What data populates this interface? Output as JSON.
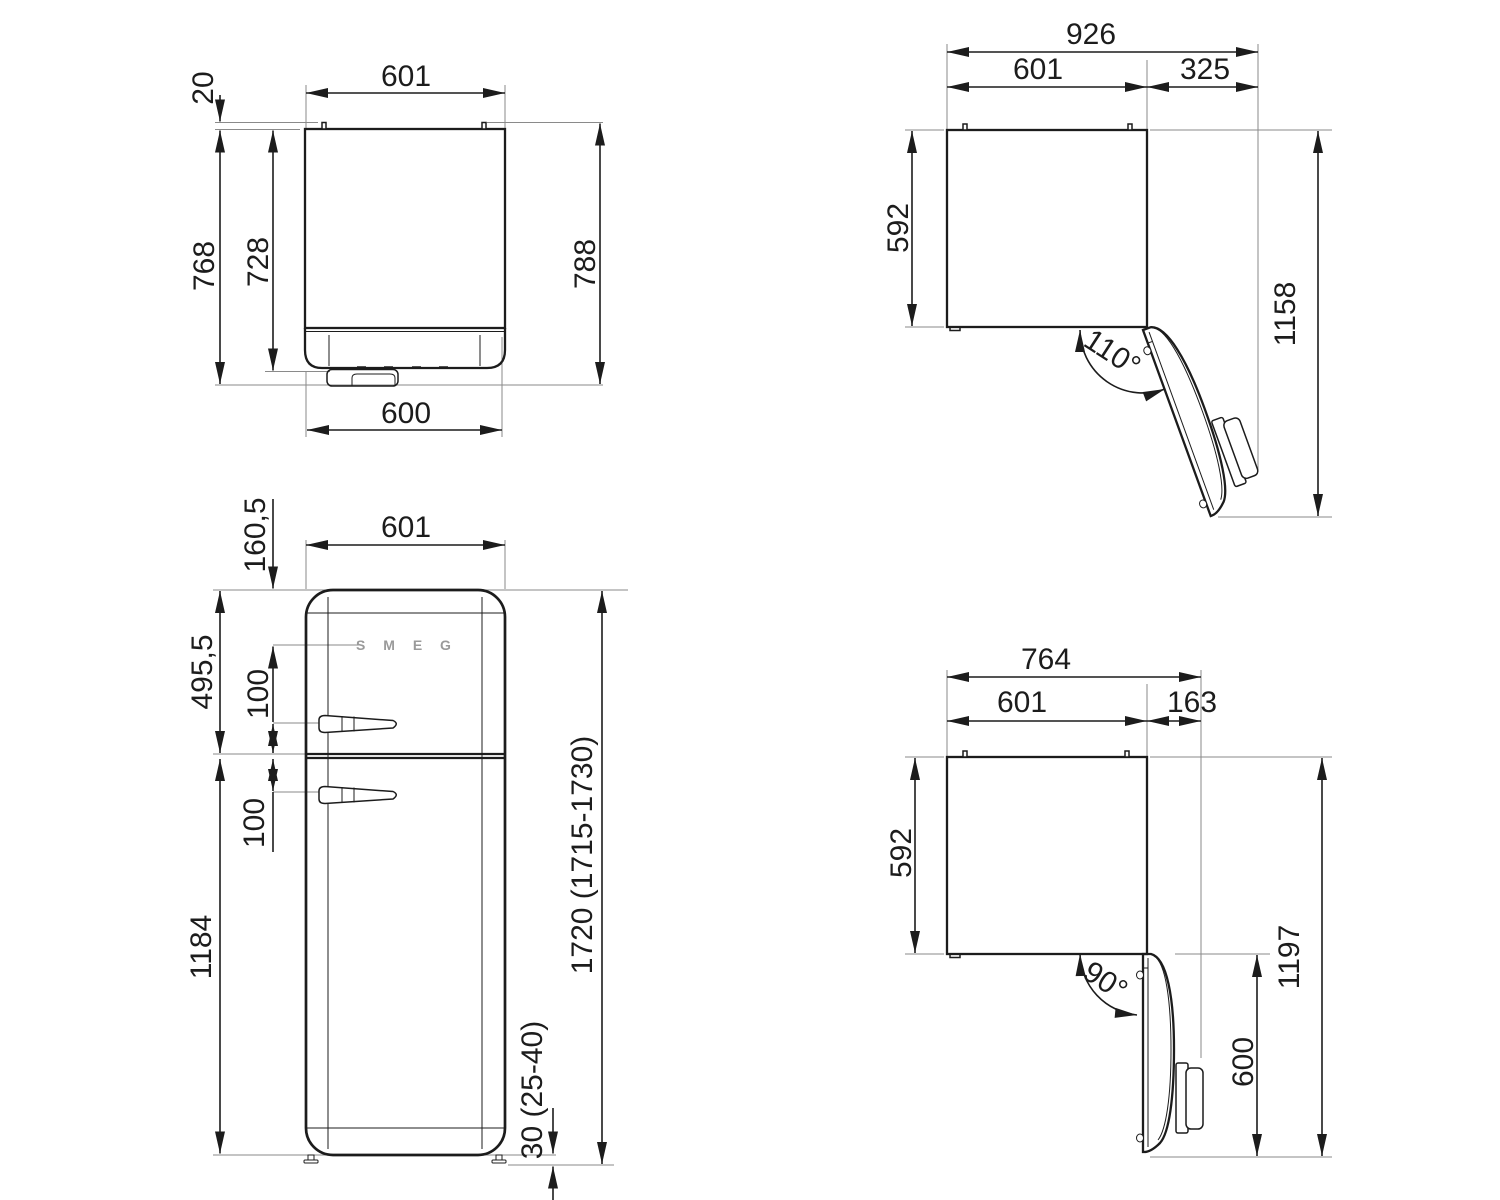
{
  "drawing": {
    "side_view": {
      "width_top": "601",
      "hinge_pin_depth": "20",
      "depth_cabinet": "768",
      "depth_inner": "728",
      "depth_total": "788",
      "width_bottom": "600"
    },
    "top_view_110": {
      "width_total": "926",
      "width_cabinet": "601",
      "door_protrusion": "325",
      "depth_cabinet": "592",
      "depth_total": "1158",
      "door_angle": "110°"
    },
    "front_view": {
      "width": "601",
      "logo_offset": "160,5",
      "logo": "S M E G",
      "upper_door_height": "495,5",
      "upper_handle_offset": "100",
      "lower_handle_offset": "100",
      "lower_door_height": "1184",
      "height_total": "1720 (1715-1730)",
      "foot_clearance": "30 (25-40)"
    },
    "top_view_90": {
      "width_total": "764",
      "width_cabinet": "601",
      "door_protrusion": "163",
      "depth_cabinet": "592",
      "depth_total": "1197",
      "door_depth": "600",
      "door_angle": "90°"
    }
  },
  "colors": {
    "line": "#1c1c1c",
    "extension_line": "#8a8a8a",
    "logo_gray": "#9a9a9a",
    "background": "#ffffff"
  }
}
